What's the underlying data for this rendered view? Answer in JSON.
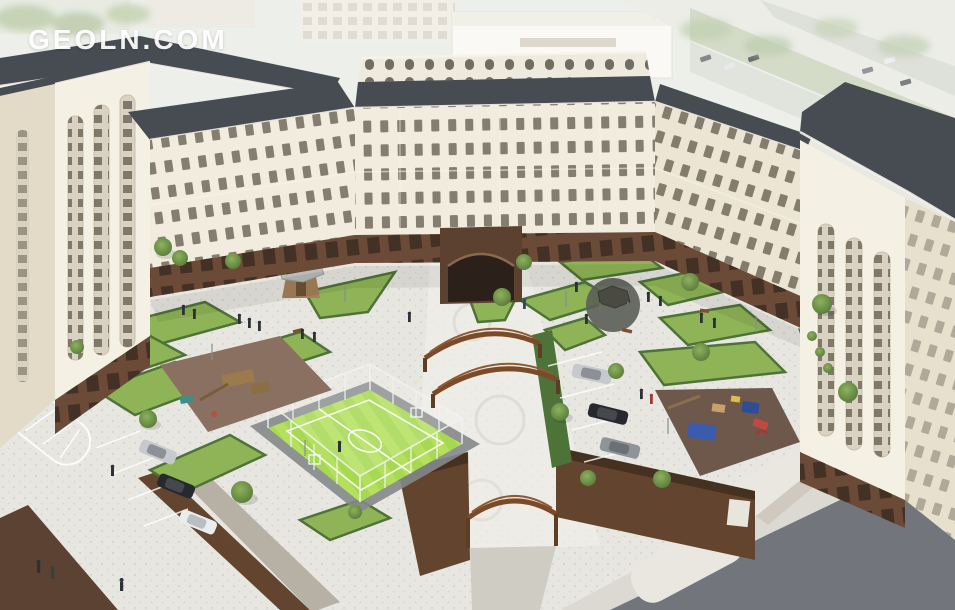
{
  "watermark": {
    "text": "GEOLN.COM"
  },
  "scene": {
    "palette": {
      "sky_haze": "#e9ebe5",
      "facade": "#f1ecdd",
      "facade_shadow": "#e3dbc8",
      "roof": "#474c52",
      "window": "#6a6154",
      "ground_floor": "#6b4a38",
      "pavement": "#e8e6e0",
      "road": "#72767c",
      "sidewalk": "#dbd9d1",
      "lawn": "#8fb457",
      "lawn_light": "#a5c767",
      "hedge": "#4e7338",
      "turf": "#a7d851",
      "turf_stripe": "#b8e261",
      "playground_left_surface": "#8a7060",
      "playground_right_surface": "#6e584b",
      "brick_wall": "#63452f",
      "pergola": "#7b4a28",
      "gazebo_roof": "#b9bdb9",
      "gazebo_wood": "#a5815a",
      "equipment_blue": "#3b5cae",
      "equipment_red": "#bf4a41",
      "car_silver": "#c6c9cd",
      "car_black": "#26292d",
      "car_gray": "#8f9499",
      "car_white": "#eaecee",
      "tree": "#6f9c45",
      "people": "#2c3138",
      "watermark": "#ffffff"
    }
  }
}
